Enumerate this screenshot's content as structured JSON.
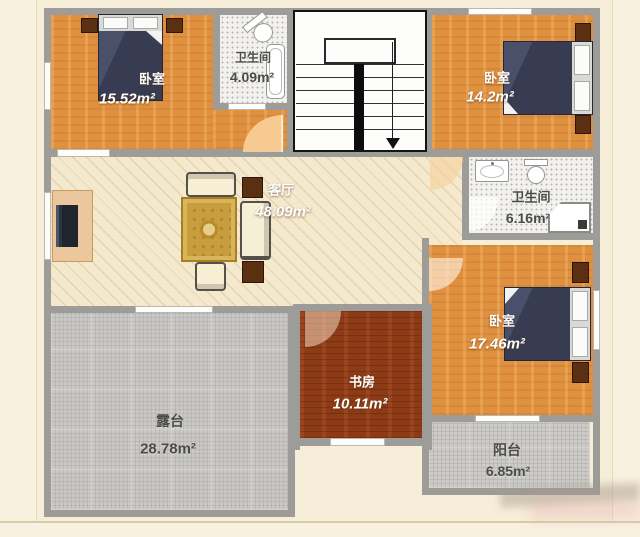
{
  "plan_title": "second-floor plan",
  "rooms": {
    "bedroom1": {
      "name": "卧室",
      "area": "15.52m²"
    },
    "bathroom1": {
      "name": "卫生间",
      "area": "4.09m²"
    },
    "bedroom2": {
      "name": "卧室",
      "area": "14.2m²"
    },
    "bathroom2": {
      "name": "卫生间",
      "area": "6.16m²"
    },
    "living": {
      "name": "客厅",
      "area": "48.09m²"
    },
    "study": {
      "name": "书房",
      "area": "10.11m²"
    },
    "terrace": {
      "name": "露台",
      "area": "28.78m²"
    },
    "bedroom3": {
      "name": "卧室",
      "area": "17.46m²"
    },
    "balcony": {
      "name": "阳台",
      "area": "6.85m²"
    }
  },
  "colors": {
    "background": "#f6eed8",
    "wall": "#9d9c98",
    "bedroom_floor": "#e09140",
    "study_floor": "#8d3a16",
    "living_floor": "#f4e9cd",
    "bathroom_tile": "#f2f1ee",
    "terrace_floor": "#c9c8c4",
    "bed_duvet": "#383c52",
    "wood_furniture": "#5b2f12",
    "rug": "#c79d3e"
  }
}
